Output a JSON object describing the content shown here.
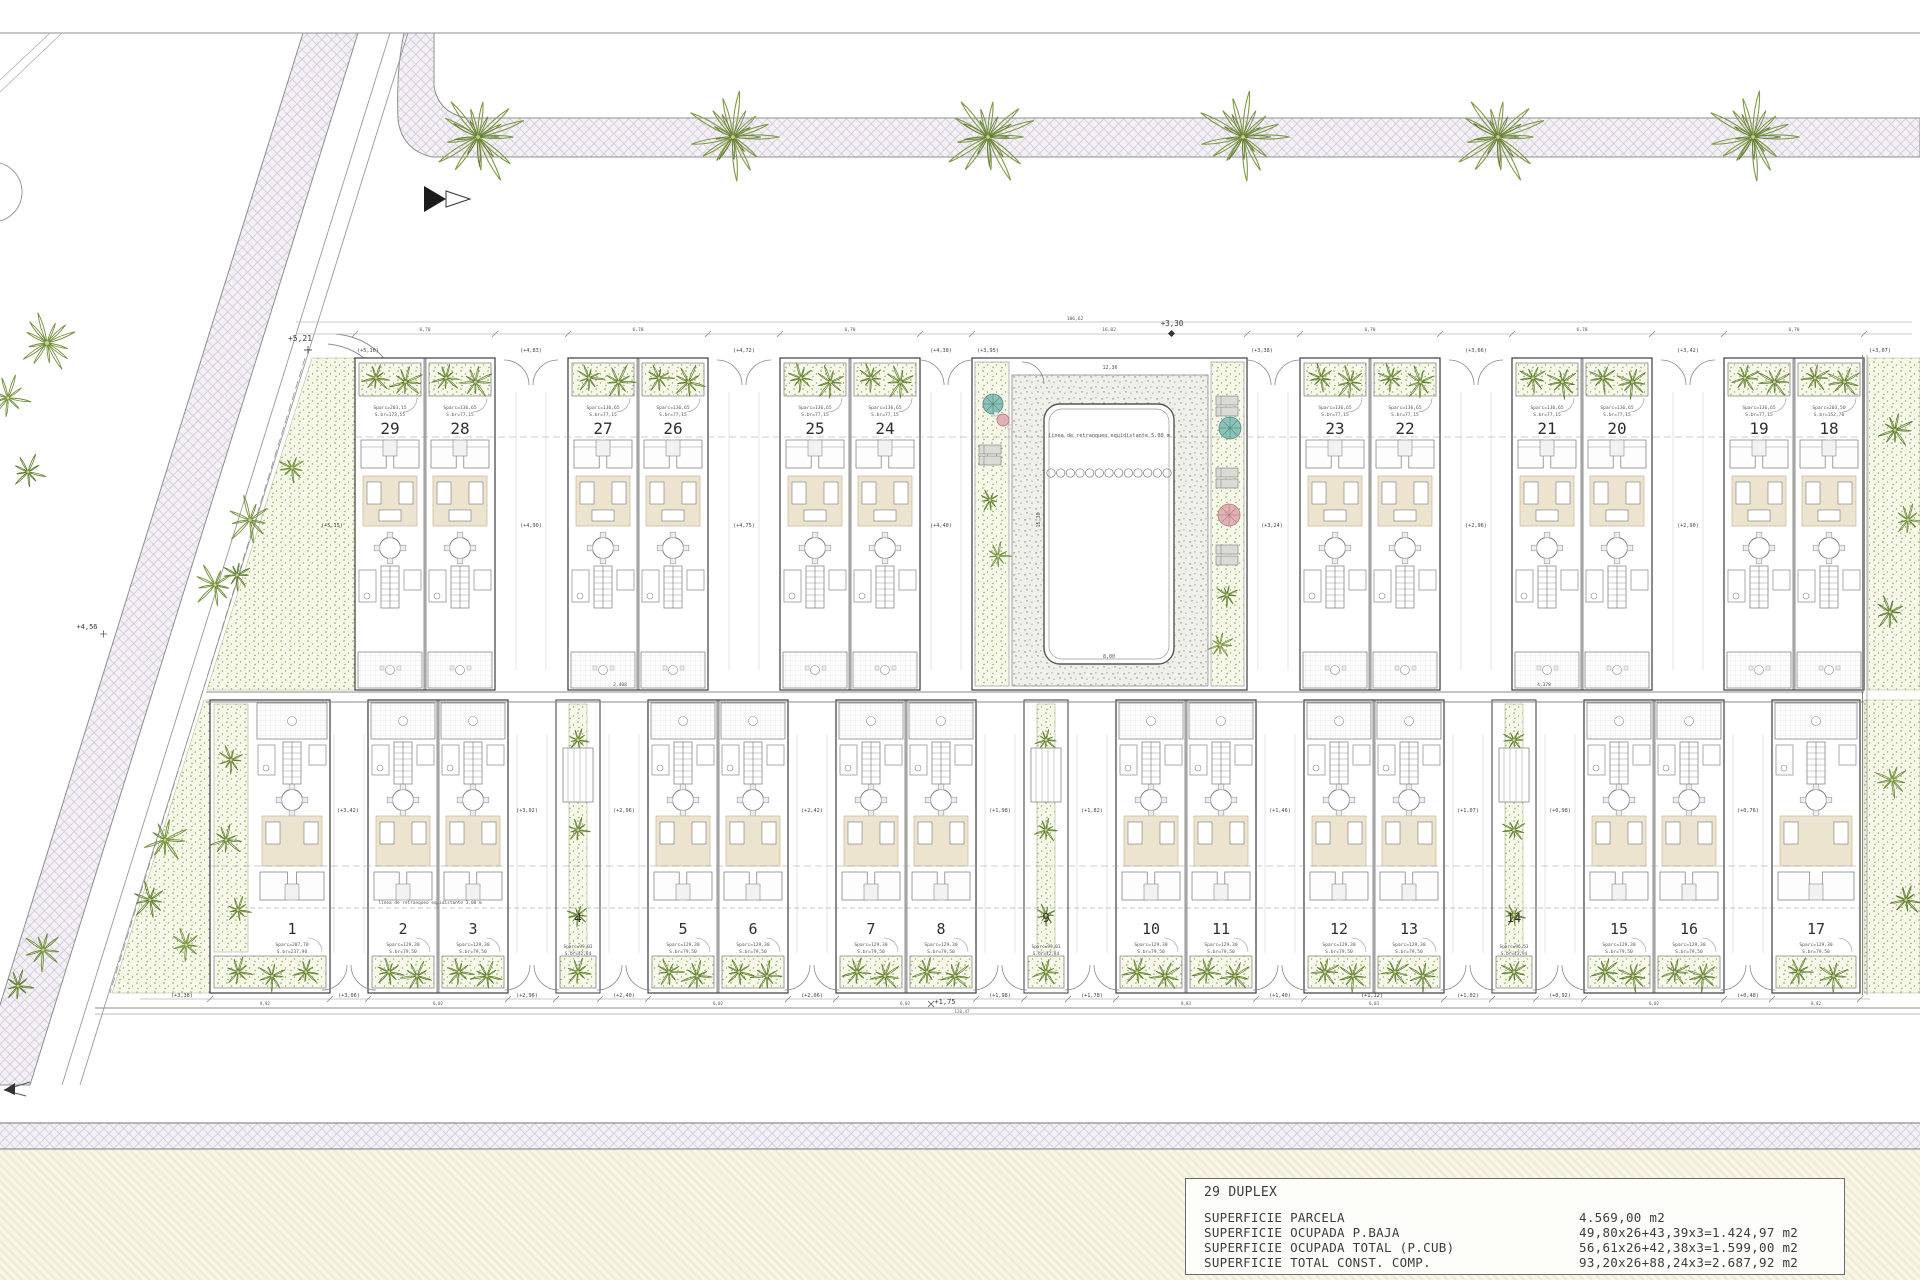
{
  "title_block": {
    "project": "29 DUPLEX",
    "rows": [
      {
        "label": "SUPERFICIE PARCELA",
        "value": "4.569,00 m2"
      },
      {
        "label": "SUPERFICIE OCUPADA P.BAJA",
        "value": "49,80x26+43,39x3=1.424,97 m2"
      },
      {
        "label": "SUPERFICIE OCUPADA TOTAL (P.CUB)",
        "value": "56,61x26+42,38x3=1.599,00 m2"
      },
      {
        "label": "SUPERFICIE TOTAL CONST. COMP.",
        "value": "93,20x26+88,24x3=2.687,92 m2"
      }
    ]
  },
  "units": {
    "top_row_buildings": [
      {
        "x": 355,
        "w": 140,
        "units": [
          {
            "n": "29",
            "area": "Sparc=203,15",
            "built": "S.br=173,55"
          },
          {
            "n": "28",
            "area": "Sparc=136,65",
            "built": "S.br=77,15"
          }
        ]
      },
      {
        "x": 568,
        "w": 140,
        "units": [
          {
            "n": "27",
            "area": "Sparc=136,65",
            "built": "S.br=77,15"
          },
          {
            "n": "26",
            "area": "Sparc=136,65",
            "built": "S.br=77,15"
          }
        ]
      },
      {
        "x": 780,
        "w": 140,
        "units": [
          {
            "n": "25",
            "area": "Sparc=136,65",
            "built": "S.br=77,15"
          },
          {
            "n": "24",
            "area": "Sparc=136,65",
            "built": "S.br=77,15"
          }
        ]
      },
      {
        "x": 1300,
        "w": 140,
        "units": [
          {
            "n": "23",
            "area": "Sparc=136,65",
            "built": "S.br=77,15"
          },
          {
            "n": "22",
            "area": "Sparc=136,65",
            "built": "S.br=77,15"
          }
        ]
      },
      {
        "x": 1512,
        "w": 140,
        "units": [
          {
            "n": "21",
            "area": "Sparc=136,65",
            "built": "S.br=77,15"
          },
          {
            "n": "20",
            "area": "Sparc=136,65",
            "built": "S.br=77,15"
          }
        ]
      },
      {
        "x": 1724,
        "w": 140,
        "units": [
          {
            "n": "19",
            "area": "Sparc=136,65",
            "built": "S.br=77,15"
          },
          {
            "n": "18",
            "area": "Sparc=203,50",
            "built": "S.br=152,70"
          }
        ]
      }
    ],
    "bottom_row_items": [
      {
        "type": "corner1",
        "x": 210,
        "w": 120,
        "unit": {
          "n": "1",
          "area": "Sparc=287,70",
          "built": "S.br=237,90"
        }
      },
      {
        "type": "bldg",
        "x": 368,
        "w": 140,
        "units": [
          {
            "n": "2",
            "area": "Sparc=129,30",
            "built": "S.br=79,50"
          },
          {
            "n": "3",
            "area": "Sparc=129,30",
            "built": "S.br=79,50"
          }
        ]
      },
      {
        "type": "link",
        "x": 556,
        "w": 44,
        "unit": {
          "n": "4",
          "area": "Sparc=99,03",
          "built": "S.br=42,84"
        }
      },
      {
        "type": "bldg",
        "x": 648,
        "w": 140,
        "units": [
          {
            "n": "5",
            "area": "Sparc=129,30",
            "built": "S.br=79,50"
          },
          {
            "n": "6",
            "area": "Sparc=129,30",
            "built": "S.br=79,50"
          }
        ]
      },
      {
        "type": "bldg",
        "x": 836,
        "w": 140,
        "units": [
          {
            "n": "7",
            "area": "Sparc=129,30",
            "built": "S.br=79,50"
          },
          {
            "n": "8",
            "area": "Sparc=129,30",
            "built": "S.br=79,50"
          }
        ]
      },
      {
        "type": "link",
        "x": 1024,
        "w": 44,
        "unit": {
          "n": "9",
          "area": "Sparc=99,03",
          "built": "S.br=42,84"
        }
      },
      {
        "type": "bldg",
        "x": 1116,
        "w": 140,
        "units": [
          {
            "n": "10",
            "area": "Sparc=129,30",
            "built": "S.br=79,50"
          },
          {
            "n": "11",
            "area": "Sparc=129,30",
            "built": "S.br=79,50"
          }
        ]
      },
      {
        "type": "bldg",
        "x": 1304,
        "w": 140,
        "units": [
          {
            "n": "12",
            "area": "Sparc=129,30",
            "built": "S.br=79,50"
          },
          {
            "n": "13",
            "area": "Sparc=129,30",
            "built": "S.br=79,50"
          }
        ]
      },
      {
        "type": "link",
        "x": 1492,
        "w": 44,
        "unit": {
          "n": "14",
          "area": "Sparc=96,53",
          "built": "S.br=43,94"
        }
      },
      {
        "type": "bldg",
        "x": 1584,
        "w": 140,
        "units": [
          {
            "n": "15",
            "area": "Sparc=129,30",
            "built": "S.br=79,50"
          },
          {
            "n": "16",
            "area": "Sparc=129,30",
            "built": "S.br=79,50"
          }
        ]
      },
      {
        "type": "corner17",
        "x": 1772,
        "w": 88,
        "unit": {
          "n": "17",
          "area": "Sparc=129,30",
          "built": "S.br=79,50"
        }
      }
    ]
  },
  "pool": {
    "note": "línea de retranqueo equidistante 5,00 m",
    "width_dim": "12,36",
    "side_dim": "15,30",
    "span_dim": "16,82",
    "depth_dim": "8,00"
  },
  "site_notes": {
    "setback_note": "línea de retranqueo equidistante 3,00 m"
  },
  "elevation_tags": {
    "top_street": [
      {
        "t": "(+5,10)",
        "x": 368
      },
      {
        "t": "(+4,83)",
        "x": 531
      },
      {
        "t": "(+4,72)",
        "x": 744
      },
      {
        "t": "(+4,38)",
        "x": 941
      },
      {
        "t": "(+3,95)",
        "x": 988
      },
      {
        "t": "(+3,38)",
        "x": 1262
      },
      {
        "t": "(+3,66)",
        "x": 1476
      },
      {
        "t": "(+3,42)",
        "x": 1688
      },
      {
        "t": "(+3,07)",
        "x": 1880
      }
    ],
    "top_mid": [
      {
        "t": "(+5,15)",
        "x": 332
      },
      {
        "t": "(+4,90)",
        "x": 531
      },
      {
        "t": "(+4,75)",
        "x": 744
      },
      {
        "t": "(+4,40)",
        "x": 941
      },
      {
        "t": "(+3,24)",
        "x": 1272
      },
      {
        "t": "(+2,96)",
        "x": 1476
      },
      {
        "t": "(+2,90)",
        "x": 1688
      }
    ],
    "bottom_mid": [
      {
        "t": "(+3,42)",
        "x": 348
      },
      {
        "t": "(+3,02)",
        "x": 527
      },
      {
        "t": "(+2,96)",
        "x": 624
      },
      {
        "t": "(+2,42)",
        "x": 812
      },
      {
        "t": "(+1,98)",
        "x": 1000
      },
      {
        "t": "(+1,82)",
        "x": 1092
      },
      {
        "t": "(+1,46)",
        "x": 1280
      },
      {
        "t": "(+1,07)",
        "x": 1468
      },
      {
        "t": "(+0,98)",
        "x": 1560
      },
      {
        "t": "(+0,76)",
        "x": 1748
      }
    ],
    "bottom_street": [
      {
        "t": "(+3,38)",
        "x": 182
      },
      {
        "t": "(+3,06)",
        "x": 349
      },
      {
        "t": "(+2,96)",
        "x": 527
      },
      {
        "t": "(+2,40)",
        "x": 624
      },
      {
        "t": "(+2,06)",
        "x": 812
      },
      {
        "t": "(+1,98)",
        "x": 1000
      },
      {
        "t": "(+1,78)",
        "x": 1092
      },
      {
        "t": "(+1,40)",
        "x": 1280
      },
      {
        "t": "(+1,12)",
        "x": 1372
      },
      {
        "t": "(+1,02)",
        "x": 1468
      },
      {
        "t": "(+0,92)",
        "x": 1560
      },
      {
        "t": "(+0,48)",
        "x": 1748
      }
    ]
  },
  "dimensions": {
    "left_level_marker": "+5,21",
    "left_level_marker2": "+4,56",
    "top_level_marker": "+3,30",
    "top_overall": "106,62",
    "bottom_level_marker": "+1,75",
    "bottom_overall": "120,47",
    "building_width_dim": "6,70",
    "building_width_xs": [
      425,
      638,
      850,
      1370,
      1582,
      1794
    ],
    "mid_dims": [
      {
        "t": "2,408",
        "x": 620
      },
      {
        "t": "4,378",
        "x": 1544
      }
    ],
    "bottom_dims": [
      {
        "t": "8,82",
        "x": 265
      },
      {
        "t": "6,02",
        "x": 438
      },
      {
        "t": "6,02",
        "x": 718
      },
      {
        "t": "6,02",
        "x": 905
      },
      {
        "t": "8,83",
        "x": 1186
      },
      {
        "t": "6,03",
        "x": 1374
      },
      {
        "t": "6,02",
        "x": 1654
      },
      {
        "t": "8,82",
        "x": 1816
      }
    ]
  }
}
